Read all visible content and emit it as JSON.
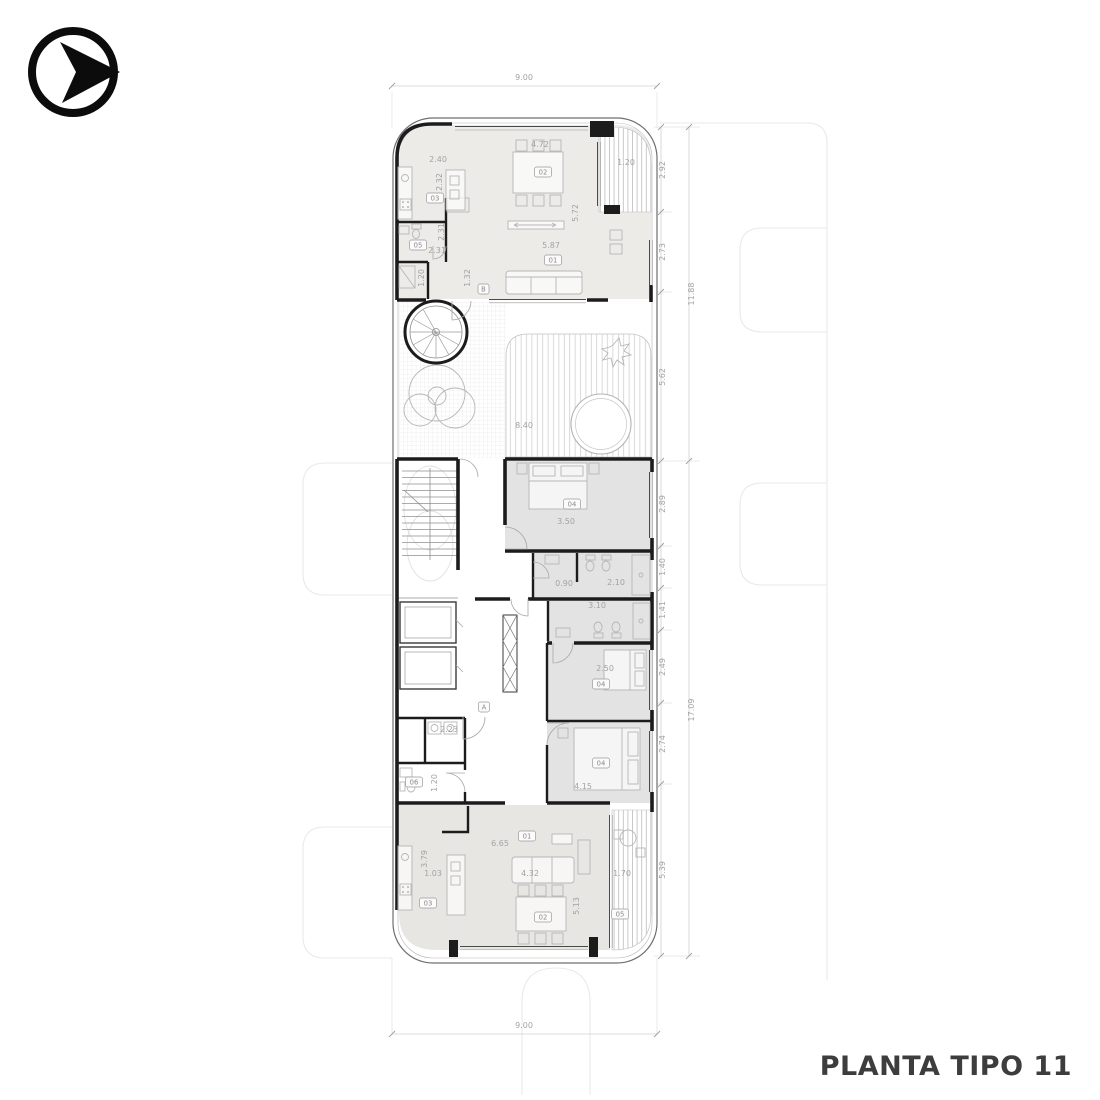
{
  "title": "PLANTA TIPO 11",
  "icons": {
    "logo": "arrow-right-circle-logo"
  },
  "colors": {
    "wall": "#1c1c1c",
    "unit_fill_top": "#ecebe7",
    "bedroom_fill": "#e3e3e3",
    "unit_fill_bottom": "#e7e6e3",
    "dim_text": "#a3a3a3",
    "neighbor_line": "#e9e9e9",
    "title_text": "#3d3d3d"
  },
  "codes": {
    "living": "01",
    "dining": "02",
    "kitchen": "03",
    "bedroom": "04",
    "balcony": "05",
    "toilet": "06"
  },
  "refs": {
    "a": "A",
    "b": "B"
  },
  "dims": {
    "lot_top": "9.00",
    "lot_bottom": "9.00",
    "right_upper": [
      "2.92",
      "2.73",
      "5.62"
    ],
    "right_upper_total": "11.88",
    "right_lower": [
      "2.89",
      "1.40",
      "1.41",
      "2.49",
      "2.74",
      "5.39"
    ],
    "right_lower_total": "17.09",
    "top_unit": {
      "kitchen_w": "2.40",
      "kitchen_d": "2.32",
      "dining_w": "4.72",
      "balcony_w": "1.20",
      "living_d": "5.72",
      "living_w": "5.87",
      "bath_w": "2.31",
      "bath_d": "2.31",
      "entry_d": "1.20",
      "hall_d": "1.32"
    },
    "terrace_w": "8.40",
    "mid": {
      "bed1_w": "3.50",
      "bath1_wc_w": "0.90",
      "bath1_w": "2.10",
      "bath2_w": "3.10",
      "bed2_w": "2.50",
      "bed3_w": "4.15",
      "laundry_w": "2.23",
      "toilet_d": "1.20"
    },
    "bottom_unit": {
      "living_w": "6.65",
      "kitchen_d": "3.79",
      "kitchen_w": "1.03",
      "sofa_w": "4.32",
      "dining_d": "5.13",
      "balcony_w": "1.70"
    }
  }
}
